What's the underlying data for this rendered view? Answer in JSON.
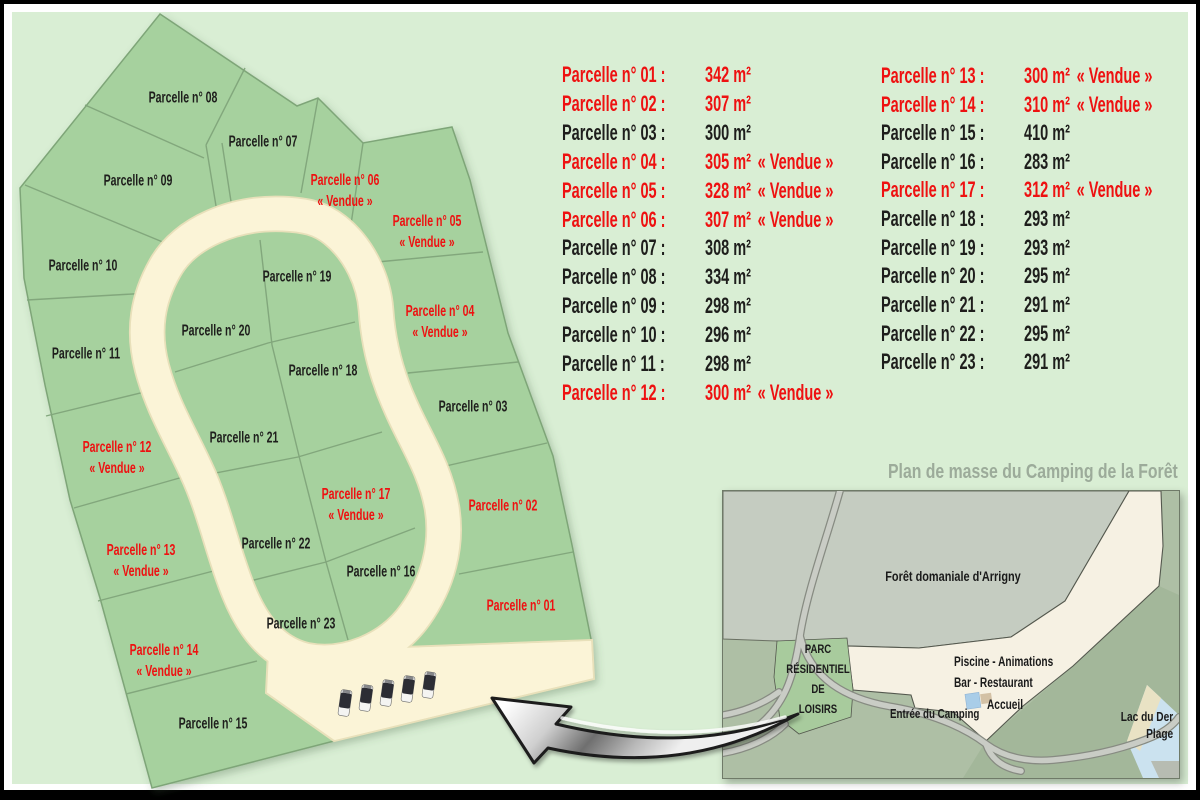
{
  "colors": {
    "page_bg": "#d9eed4",
    "parcel_green": "#a6d19e",
    "parcel_border": "#7ea578",
    "road_cream": "#fbf4d7",
    "sold_red": "#ee1111",
    "text_dark": "#1e1e1c",
    "title_gray": "#9cab9a"
  },
  "map": {
    "parcels": [
      {
        "num": "01",
        "label": "Parcelle n° 01",
        "vendue": "",
        "sold": true
      },
      {
        "num": "02",
        "label": "Parcelle n° 02",
        "vendue": "",
        "sold": true
      },
      {
        "num": "03",
        "label": "Parcelle n° 03",
        "vendue": "",
        "sold": false
      },
      {
        "num": "04",
        "label": "Parcelle n° 04",
        "vendue": "« Vendue »",
        "sold": true
      },
      {
        "num": "05",
        "label": "Parcelle n° 05",
        "vendue": "« Vendue »",
        "sold": true
      },
      {
        "num": "06",
        "label": "Parcelle n° 06",
        "vendue": "« Vendue »",
        "sold": true
      },
      {
        "num": "07",
        "label": "Parcelle n° 07",
        "vendue": "",
        "sold": false
      },
      {
        "num": "08",
        "label": "Parcelle n° 08",
        "vendue": "",
        "sold": false
      },
      {
        "num": "09",
        "label": "Parcelle n° 09",
        "vendue": "",
        "sold": false
      },
      {
        "num": "10",
        "label": "Parcelle n° 10",
        "vendue": "",
        "sold": false
      },
      {
        "num": "11",
        "label": "Parcelle n° 11",
        "vendue": "",
        "sold": false
      },
      {
        "num": "12",
        "label": "Parcelle n° 12",
        "vendue": "« Vendue »",
        "sold": true
      },
      {
        "num": "13",
        "label": "Parcelle n° 13",
        "vendue": "« Vendue »",
        "sold": true
      },
      {
        "num": "14",
        "label": "Parcelle n° 14",
        "vendue": "« Vendue »",
        "sold": true
      },
      {
        "num": "15",
        "label": "Parcelle n° 15",
        "vendue": "",
        "sold": false
      },
      {
        "num": "16",
        "label": "Parcelle n° 16",
        "vendue": "",
        "sold": false
      },
      {
        "num": "17",
        "label": "Parcelle n° 17",
        "vendue": "« Vendue »",
        "sold": true
      },
      {
        "num": "18",
        "label": "Parcelle n° 18",
        "vendue": "",
        "sold": false
      },
      {
        "num": "19",
        "label": "Parcelle n° 19",
        "vendue": "",
        "sold": false
      },
      {
        "num": "20",
        "label": "Parcelle n° 20",
        "vendue": "",
        "sold": false
      },
      {
        "num": "21",
        "label": "Parcelle n° 21",
        "vendue": "",
        "sold": false
      },
      {
        "num": "22",
        "label": "Parcelle n° 22",
        "vendue": "",
        "sold": false
      },
      {
        "num": "23",
        "label": "Parcelle n° 23",
        "vendue": "",
        "sold": false
      }
    ]
  },
  "list": {
    "items": [
      {
        "label": "Parcelle n° 01 :",
        "size": "342 m²",
        "vendue": "",
        "sold": true
      },
      {
        "label": "Parcelle n° 02 :",
        "size": "307 m²",
        "vendue": "",
        "sold": true
      },
      {
        "label": "Parcelle n° 03 :",
        "size": "300 m²",
        "vendue": "",
        "sold": false
      },
      {
        "label": "Parcelle n° 04 :",
        "size": "305 m²",
        "vendue": "« Vendue »",
        "sold": true
      },
      {
        "label": "Parcelle n° 05 :",
        "size": "328 m²",
        "vendue": "« Vendue »",
        "sold": true
      },
      {
        "label": "Parcelle n° 06 :",
        "size": "307 m²",
        "vendue": "« Vendue »",
        "sold": true
      },
      {
        "label": "Parcelle n° 07 :",
        "size": "308 m²",
        "vendue": "",
        "sold": false
      },
      {
        "label": "Parcelle n° 08 :",
        "size": "334 m²",
        "vendue": "",
        "sold": false
      },
      {
        "label": "Parcelle n° 09 :",
        "size": "298 m²",
        "vendue": "",
        "sold": false
      },
      {
        "label": "Parcelle n° 10 :",
        "size": "296 m²",
        "vendue": "",
        "sold": false
      },
      {
        "label": "Parcelle n° 11 :",
        "size": "298 m²",
        "vendue": "",
        "sold": false
      },
      {
        "label": "Parcelle n° 12 :",
        "size": "300 m²",
        "vendue": "« Vendue »",
        "sold": true
      },
      {
        "label": "Parcelle n° 13 :",
        "size": "300 m²",
        "vendue": "« Vendue »",
        "sold": true
      },
      {
        "label": "Parcelle n° 14 :",
        "size": "310 m²",
        "vendue": "« Vendue »",
        "sold": true
      },
      {
        "label": "Parcelle n° 15 :",
        "size": "410 m²",
        "vendue": "",
        "sold": false
      },
      {
        "label": "Parcelle n° 16 :",
        "size": "283 m²",
        "vendue": "",
        "sold": false
      },
      {
        "label": "Parcelle n° 17 :",
        "size": "312 m²",
        "vendue": "« Vendue »",
        "sold": true
      },
      {
        "label": "Parcelle n° 18 :",
        "size": "293 m²",
        "vendue": "",
        "sold": false
      },
      {
        "label": "Parcelle n° 19 :",
        "size": "293 m²",
        "vendue": "",
        "sold": false
      },
      {
        "label": "Parcelle n° 20 :",
        "size": "295 m²",
        "vendue": "",
        "sold": false
      },
      {
        "label": "Parcelle n° 21 :",
        "size": "291 m²",
        "vendue": "",
        "sold": false
      },
      {
        "label": "Parcelle n° 22 :",
        "size": "295 m²",
        "vendue": "",
        "sold": false
      },
      {
        "label": "Parcelle n° 23 :",
        "size": "291 m²",
        "vendue": "",
        "sold": false
      }
    ]
  },
  "inset": {
    "title": "Plan de masse du Camping de la Forêt",
    "forest_label": "Forêt domaniale d'Arrigny",
    "prl_lines": [
      "PARC",
      "RÉSIDENTIEL",
      "DE",
      "LOISIRS"
    ],
    "piscine_label": "Piscine - Animations",
    "bar_label": "Bar - Restaurant",
    "accueil_label": "Accueil",
    "entree_label": "Entrée du Camping",
    "lac_line1": "Lac du Der",
    "lac_line2": "Plage"
  }
}
